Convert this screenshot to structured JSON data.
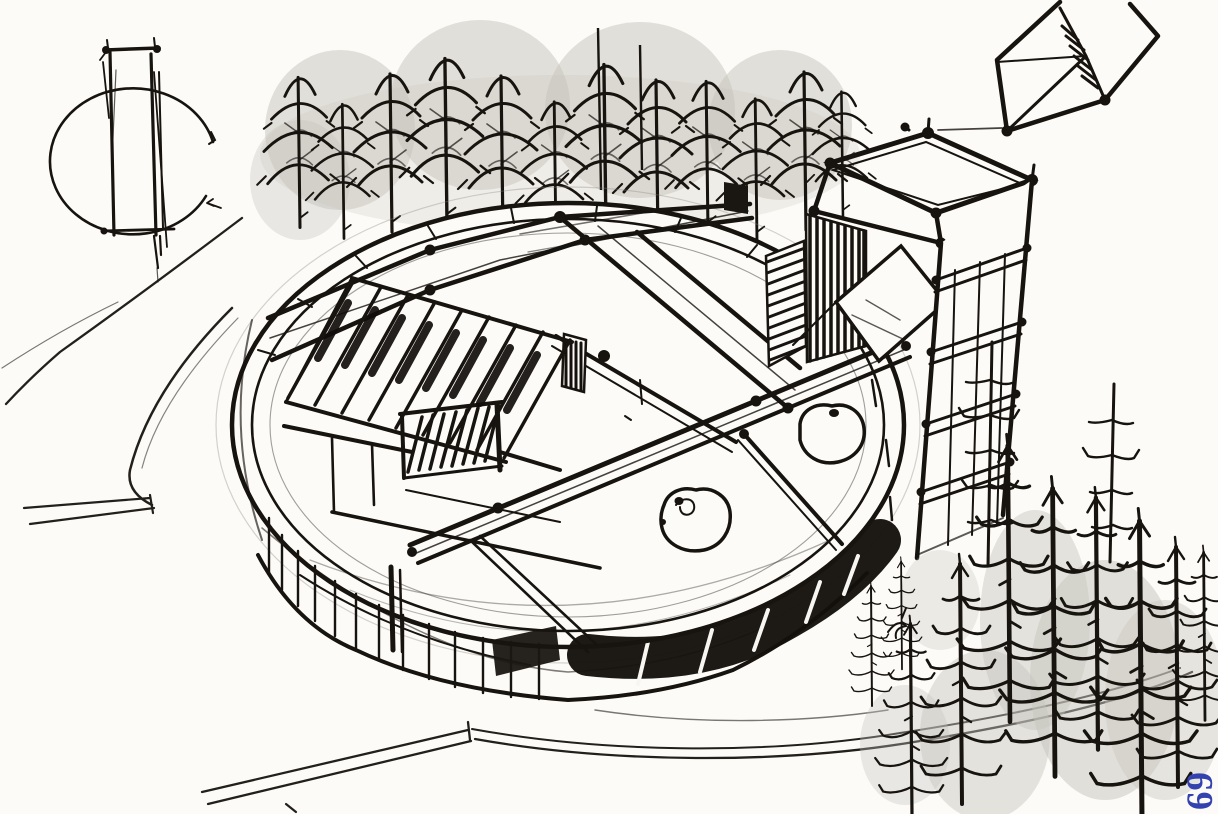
{
  "canvas": {
    "width": 1218,
    "height": 814,
    "background": "#fcfbf7"
  },
  "palette": {
    "ink": "#17130f",
    "ink_soft": "#3e3831",
    "pencil": "#8a857c",
    "wash_gray": "#c6c3bc",
    "paper": "#fcfbf7",
    "page_number_blue": "#3342ae"
  },
  "footer": {
    "page_number": "69"
  },
  "icons": {
    "arrow_mark": "small-arrow-annotation"
  }
}
